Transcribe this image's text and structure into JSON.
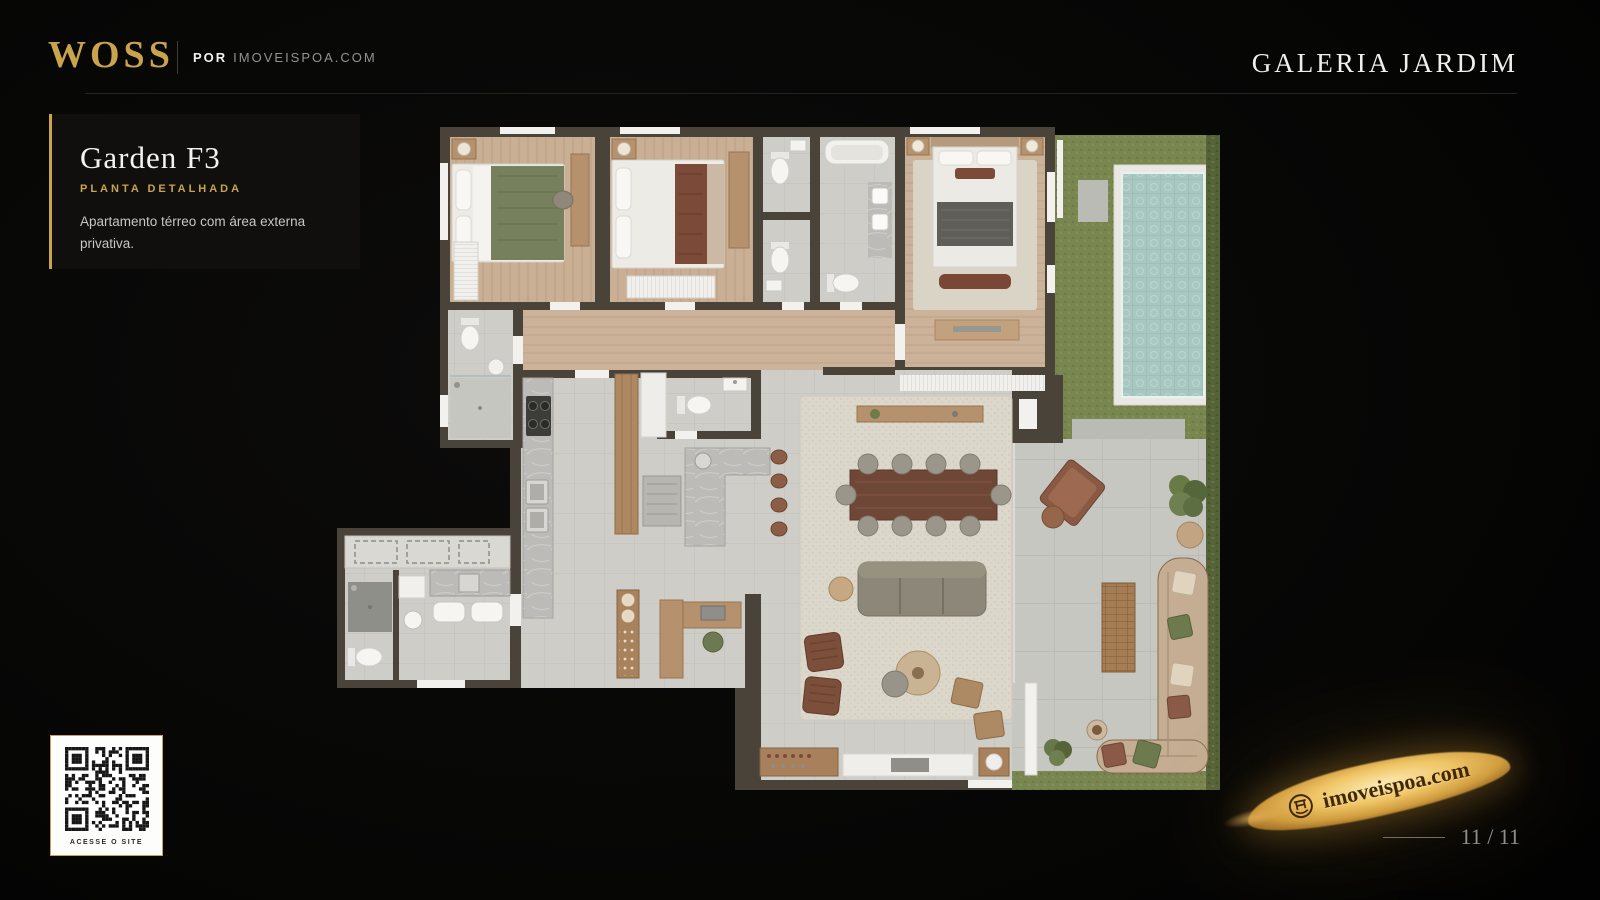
{
  "header": {
    "brand": "WOSS",
    "byline_prefix": "POR",
    "byline_site": "IMOVEISPOA.COM",
    "project": "GALERIA JARDIM"
  },
  "info_panel": {
    "title": "Garden F3",
    "subtitle": "PLANTA DETALHADA",
    "description": "Apartamento térreo com área externa privativa."
  },
  "qr": {
    "caption": "ACESSE O SITE"
  },
  "footer": {
    "watermark": "imoveispoa.com",
    "page_indicator": "11 / 11"
  },
  "colors": {
    "gold_accent": "#C9A44C",
    "background": "#050505",
    "panel_background": "#100F0D",
    "wall": "#4A4339",
    "wood_floor": "#C9AF94",
    "tile_floor": "#CECDC8",
    "grass": "#79864F",
    "hedge": "#566339",
    "pool_water": "#A9C7C1",
    "pool_deck": "#EAE8E2",
    "rug": "#DBD7CB"
  }
}
